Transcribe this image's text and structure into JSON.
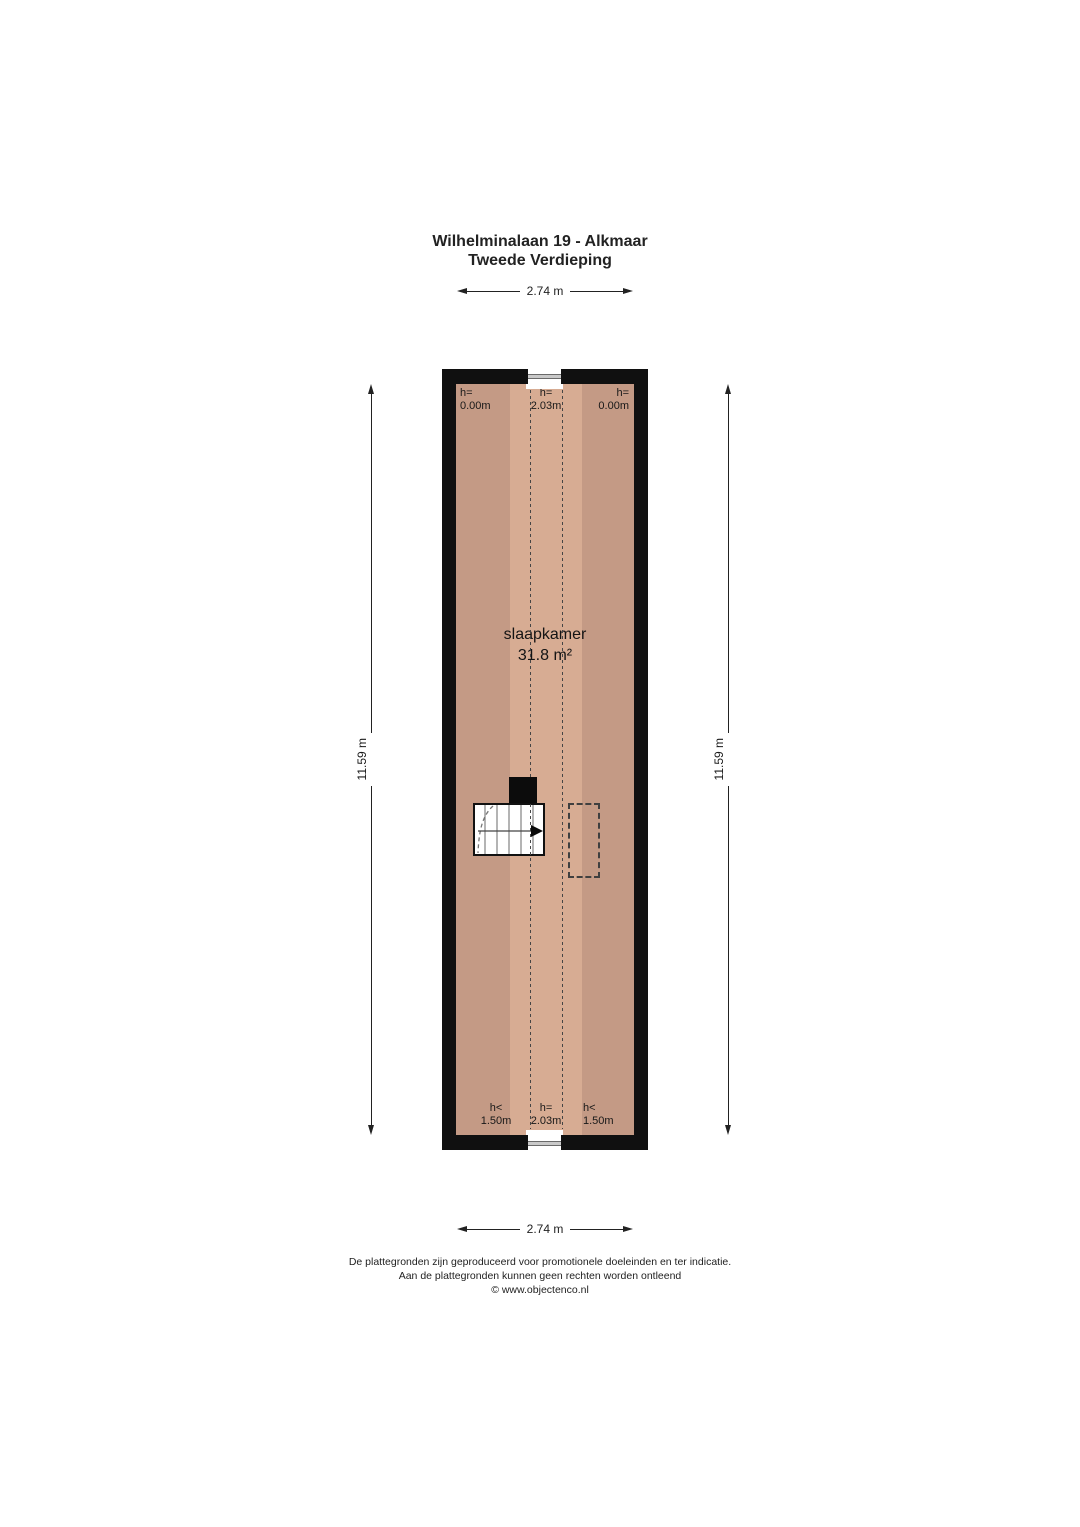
{
  "title": {
    "line1": "Wilhelminalaan 19 - Alkmaar",
    "line2": "Tweede Verdieping"
  },
  "dimensions": {
    "top_width": "2.74 m",
    "bottom_width": "2.74 m",
    "left_height": "11.59 m",
    "right_height": "11.59 m"
  },
  "room": {
    "name": "slaapkamer",
    "area": "31.8 m²",
    "height_labels": {
      "top_left": {
        "l1": "h=",
        "l2": "0.00m"
      },
      "top_center": {
        "l1": "h=",
        "l2": "2.03m"
      },
      "top_right": {
        "l1": "h=",
        "l2": "0.00m"
      },
      "bottom_left": {
        "l1": "h<",
        "l2": "1.50m"
      },
      "bottom_center": {
        "l1": "h=",
        "l2": "2.03m"
      },
      "bottom_right": {
        "l1": "h<",
        "l2": "1.50m"
      }
    }
  },
  "footer": {
    "line1": "De plattegronden zijn geproduceerd voor promotionele doeleinden en ter indicatie.",
    "line2": "Aan de plattegronden kunnen geen rechten worden ontleend",
    "line3": "© www.objectenco.nl"
  },
  "colors": {
    "wall": "#101010",
    "floor_side": "#c49a85",
    "floor_center": "#d7ac93"
  }
}
